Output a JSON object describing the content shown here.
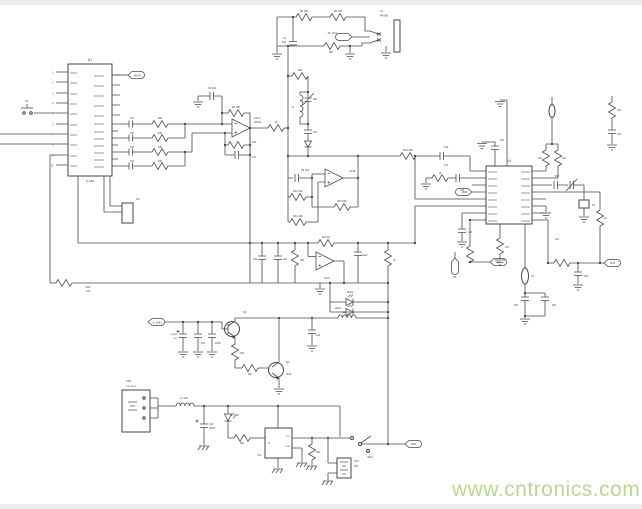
{
  "title": "circuit-schematic-scan",
  "colors": {
    "wire": "#4a4a4a",
    "text": "#3a3a3a",
    "watermark": "#b6db90",
    "background": "#ffffff"
  },
  "watermark": {
    "text": "www.cntronics.com"
  },
  "components": {
    "u1": {
      "ref": "U1",
      "part": "P-049"
    },
    "u2": {
      "ref": "U2",
      "part": "LM324",
      "sections": [
        "U2:A",
        "U2:B",
        "U2:C"
      ]
    },
    "u3": {
      "ref": "U3",
      "pins": [
        "IN",
        "OUT",
        "GND"
      ]
    },
    "u4": {
      "ref": "U4"
    },
    "j1": {
      "ref": "J1",
      "type": "PHONE"
    },
    "cn1": {
      "ref": "CN1",
      "type": "OSC MOD"
    },
    "cn3": {
      "ref": "CN3",
      "type": "BAT"
    },
    "sw1": {
      "ref": "SW1"
    },
    "nets": [
      "MUTE",
      "AF_OUT",
      "A_VDD",
      "VDD",
      "ANT",
      "MOD",
      "RF",
      "AFC"
    ]
  },
  "labels": [
    {
      "t": "U1",
      "x": 90,
      "y": 61,
      "s": 3.5
    },
    {
      "t": "P-049",
      "x": 90,
      "y": 182,
      "s": 3
    },
    {
      "t": "MUTE",
      "x": 137.5,
      "y": 76.5,
      "s": 2.6
    },
    {
      "t": "S1",
      "x": 27,
      "y": 102,
      "s": 2.8
    },
    {
      "t": "NC",
      "x": 136,
      "y": 200,
      "s": 2.6,
      "a": "s"
    },
    {
      "t": "1",
      "x": 53.5,
      "y": 73.5,
      "s": 2.4,
      "a": "e"
    },
    {
      "t": "2",
      "x": 53.5,
      "y": 83.5,
      "s": 2.4,
      "a": "e"
    },
    {
      "t": "3",
      "x": 53.5,
      "y": 94.5,
      "s": 2.4,
      "a": "e"
    },
    {
      "t": "4",
      "x": 53.5,
      "y": 104.5,
      "s": 2.4,
      "a": "e"
    },
    {
      "t": "5",
      "x": 53.5,
      "y": 114.5,
      "s": 2.4,
      "a": "e"
    },
    {
      "t": "6",
      "x": 53.5,
      "y": 125.5,
      "s": 2.4,
      "a": "e"
    },
    {
      "t": "7",
      "x": 53.5,
      "y": 135.5,
      "s": 2.4,
      "a": "e"
    },
    {
      "t": "8",
      "x": 53.5,
      "y": 145.5,
      "s": 2.4,
      "a": "e"
    },
    {
      "t": "9",
      "x": 53.5,
      "y": 156.5,
      "s": 2.4,
      "a": "e"
    },
    {
      "t": "10",
      "x": 53.5,
      "y": 166.5,
      "s": 2.4,
      "a": "e"
    },
    {
      "t": "R22",
      "x": 88,
      "y": 288,
      "s": 2.4
    },
    {
      "t": "103",
      "x": 88,
      "y": 292,
      "s": 2.4
    },
    {
      "t": "104",
      "x": 132,
      "y": 119,
      "s": 2.4
    },
    {
      "t": "104",
      "x": 132,
      "y": 134,
      "s": 2.4
    },
    {
      "t": "104",
      "x": 132,
      "y": 148,
      "s": 2.4
    },
    {
      "t": "104",
      "x": 132,
      "y": 162,
      "s": 2.4
    },
    {
      "t": "20K",
      "x": 160,
      "y": 119,
      "s": 2.4
    },
    {
      "t": "20K",
      "x": 160,
      "y": 134,
      "s": 2.4
    },
    {
      "t": "20K",
      "x": 160,
      "y": 148,
      "s": 2.4
    },
    {
      "t": "20K",
      "x": 160,
      "y": 162,
      "s": 2.4
    },
    {
      "t": "C5 104",
      "x": 212,
      "y": 89,
      "s": 2.5
    },
    {
      "t": "R6 10K",
      "x": 236,
      "y": 108,
      "s": 2.5
    },
    {
      "t": "U2:A",
      "x": 254,
      "y": 119,
      "s": 2.8,
      "a": "s"
    },
    {
      "t": "LM324",
      "x": 254,
      "y": 123,
      "s": 2.3,
      "a": "s"
    },
    {
      "t": "2K0",
      "x": 252,
      "y": 143,
      "s": 2.4,
      "a": "s"
    },
    {
      "t": "472",
      "x": 252,
      "y": 158,
      "s": 2.4,
      "a": "s"
    },
    {
      "t": "1K",
      "x": 276,
      "y": 123,
      "s": 2.5
    },
    {
      "t": "R8 10K",
      "x": 304,
      "y": 12,
      "s": 2.5
    },
    {
      "t": "R9 10K",
      "x": 338,
      "y": 12,
      "s": 2.5
    },
    {
      "t": "C7",
      "x": 286,
      "y": 39,
      "s": 2.4,
      "a": "e"
    },
    {
      "t": "104",
      "x": 286,
      "y": 43,
      "s": 2.4,
      "a": "e"
    },
    {
      "t": "AF_OUT",
      "x": 337,
      "y": 34,
      "s": 2.4,
      "a": "e"
    },
    {
      "t": "680",
      "x": 331,
      "y": 53,
      "s": 2.4
    },
    {
      "t": "J1",
      "x": 380,
      "y": 12,
      "s": 2.8,
      "a": "s"
    },
    {
      "t": "PHONE",
      "x": 380,
      "y": 16.5,
      "s": 2.3,
      "a": "s"
    },
    {
      "t": "680",
      "x": 300,
      "y": 71,
      "s": 2.4
    },
    {
      "t": "L3",
      "x": 294,
      "y": 108,
      "s": 2.4,
      "a": "e"
    },
    {
      "t": "30P",
      "x": 313,
      "y": 100,
      "s": 2.4,
      "a": "s"
    },
    {
      "t": "104",
      "x": 313,
      "y": 133,
      "s": 2.4,
      "a": "s"
    },
    {
      "t": "R18 10K",
      "x": 408,
      "y": 151,
      "s": 2.5
    },
    {
      "t": "C19",
      "x": 446,
      "y": 148,
      "s": 2.4
    },
    {
      "t": "473",
      "x": 446,
      "y": 166,
      "s": 2.4
    },
    {
      "t": "C9 104",
      "x": 305,
      "y": 171,
      "s": 2.5
    },
    {
      "t": "R10 10K",
      "x": 298,
      "y": 192,
      "s": 2.5
    },
    {
      "t": "R11 20K",
      "x": 298,
      "y": 217,
      "s": 2.5
    },
    {
      "t": "U2:B",
      "x": 349,
      "y": 172,
      "s": 2.8,
      "a": "s"
    },
    {
      "t": "R12 62K",
      "x": 342,
      "y": 202,
      "s": 2.5
    },
    {
      "t": "R13 1K",
      "x": 326,
      "y": 238,
      "s": 2.5
    },
    {
      "t": "104",
      "x": 257,
      "y": 260,
      "s": 2.4,
      "a": "e"
    },
    {
      "t": "103",
      "x": 283,
      "y": 260,
      "s": 2.4,
      "a": "s"
    },
    {
      "t": "20K",
      "x": 300,
      "y": 261,
      "s": 2.4,
      "a": "s"
    },
    {
      "t": "U2:C",
      "x": 327,
      "y": 279,
      "s": 2.8
    },
    {
      "t": "10uF",
      "x": 362,
      "y": 256,
      "s": 2.4,
      "a": "s"
    },
    {
      "t": "1K",
      "x": 393,
      "y": 261,
      "s": 2.4,
      "a": "s"
    },
    {
      "t": "LED1",
      "x": 350,
      "y": 293,
      "s": 2.5
    },
    {
      "t": "LED2",
      "x": 341,
      "y": 309,
      "s": 2.5,
      "a": "e"
    },
    {
      "t": "L2 100",
      "x": 347,
      "y": 313,
      "s": 2.5
    },
    {
      "t": "A_VDD",
      "x": 157,
      "y": 323.5,
      "s": 2.7
    },
    {
      "t": "220UF",
      "x": 177,
      "y": 335,
      "s": 2.2,
      "a": "e"
    },
    {
      "t": "16V",
      "x": 177,
      "y": 339,
      "s": 2.2,
      "a": "e"
    },
    {
      "t": "104",
      "x": 201,
      "y": 344,
      "s": 2.4,
      "a": "s"
    },
    {
      "t": "10UF",
      "x": 215,
      "y": 344,
      "s": 2.4,
      "a": "s"
    },
    {
      "t": "Q1",
      "x": 243,
      "y": 313,
      "s": 2.8,
      "a": "s"
    },
    {
      "t": "2K0",
      "x": 240,
      "y": 354,
      "s": 2.4,
      "a": "s"
    },
    {
      "t": "560",
      "x": 250,
      "y": 375,
      "s": 2.4
    },
    {
      "t": "Q2",
      "x": 286,
      "y": 363,
      "s": 2.8,
      "a": "s"
    },
    {
      "t": "9014",
      "x": 286,
      "y": 375,
      "s": 2.4,
      "a": "s"
    },
    {
      "t": "104",
      "x": 316,
      "y": 336,
      "s": 2.4,
      "a": "s"
    },
    {
      "t": "U4",
      "x": 509,
      "y": 162,
      "s": 3.5
    },
    {
      "t": "1K",
      "x": 440,
      "y": 174,
      "s": 2.4
    },
    {
      "t": "104",
      "x": 460,
      "y": 191,
      "s": 2.4,
      "a": "s"
    },
    {
      "t": "MOD",
      "x": 464.5,
      "y": 193,
      "s": 2.3
    },
    {
      "t": "104",
      "x": 468,
      "y": 233,
      "s": 2.4,
      "a": "s"
    },
    {
      "t": "RF",
      "x": 455,
      "y": 278,
      "s": 2.4
    },
    {
      "t": "AFC",
      "x": 498.5,
      "y": 263,
      "s": 2.3
    },
    {
      "t": "47K",
      "x": 505,
      "y": 248,
      "s": 2.4,
      "a": "s"
    },
    {
      "t": "104",
      "x": 500,
      "y": 141,
      "s": 2.4,
      "a": "s"
    },
    {
      "t": "X2",
      "x": 531,
      "y": 277,
      "s": 2.5,
      "a": "s"
    },
    {
      "t": "22P",
      "x": 518,
      "y": 306,
      "s": 2.3,
      "a": "e"
    },
    {
      "t": "22P",
      "x": 552,
      "y": 306,
      "s": 2.3,
      "a": "s"
    },
    {
      "t": "10K",
      "x": 542,
      "y": 159,
      "s": 2.4,
      "a": "e"
    },
    {
      "t": "10K",
      "x": 562,
      "y": 159,
      "s": 2.4,
      "a": "s"
    },
    {
      "t": "30P",
      "x": 557,
      "y": 177,
      "s": 2.4
    },
    {
      "t": "X1",
      "x": 592,
      "y": 206,
      "s": 2.5,
      "a": "s"
    },
    {
      "t": "1K",
      "x": 604,
      "y": 219,
      "s": 2.4,
      "a": "s"
    },
    {
      "t": "ANT",
      "x": 612.5,
      "y": 264,
      "s": 2.6
    },
    {
      "t": "10P",
      "x": 584,
      "y": 277,
      "s": 2.4,
      "a": "s"
    },
    {
      "t": "104",
      "x": 555,
      "y": 240,
      "s": 2.4,
      "a": "s"
    },
    {
      "t": "10K",
      "x": 617,
      "y": 111,
      "s": 2.4,
      "a": "s"
    },
    {
      "t": "104",
      "x": 617,
      "y": 135,
      "s": 2.4,
      "a": "s"
    },
    {
      "t": "CN1",
      "x": 126,
      "y": 382,
      "s": 2.8,
      "a": "s"
    },
    {
      "t": "OSC MOD",
      "x": 126,
      "y": 387,
      "s": 2.2,
      "a": "s"
    },
    {
      "t": "L1 100",
      "x": 184,
      "y": 399,
      "s": 2.5
    },
    {
      "t": "C24",
      "x": 209,
      "y": 425,
      "s": 2.3,
      "a": "s"
    },
    {
      "t": "100uF",
      "x": 209,
      "y": 429,
      "s": 2.3,
      "a": "s"
    },
    {
      "t": "LED",
      "x": 234,
      "y": 416,
      "s": 2.4,
      "a": "s"
    },
    {
      "t": "680",
      "x": 242,
      "y": 444,
      "s": 2.4
    },
    {
      "t": "U3",
      "x": 261,
      "y": 456,
      "s": 2.8,
      "a": "e"
    },
    {
      "t": "IN",
      "x": 268,
      "y": 444,
      "s": 2,
      "a": "s"
    },
    {
      "t": "OUT",
      "x": 290,
      "y": 437,
      "s": 2,
      "a": "e"
    },
    {
      "t": "GND",
      "x": 290,
      "y": 447,
      "s": 2,
      "a": "e"
    },
    {
      "t": "10K",
      "x": 316,
      "y": 453,
      "s": 2.4,
      "a": "s"
    },
    {
      "t": "SW1",
      "x": 370,
      "y": 458,
      "s": 2.6
    },
    {
      "t": "CN3",
      "x": 354,
      "y": 462,
      "s": 2.3,
      "a": "s"
    },
    {
      "t": "BAT",
      "x": 354,
      "y": 467,
      "s": 2.3,
      "a": "s"
    },
    {
      "t": "VDD",
      "x": 413.5,
      "y": 445,
      "s": 2.6
    }
  ]
}
